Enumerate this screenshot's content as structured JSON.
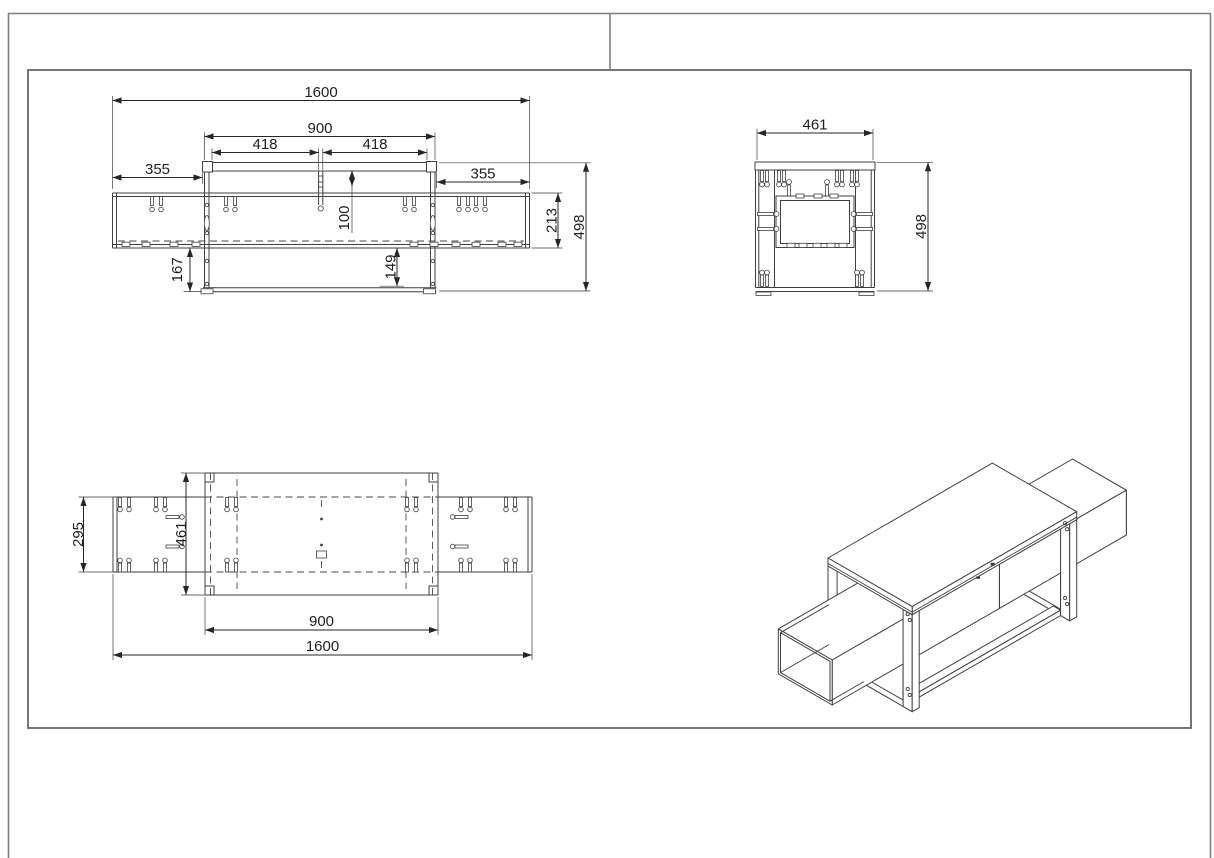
{
  "page": {
    "background": "#ffffff",
    "frame_color": "#7e7e7e",
    "line_color": "#3f3f3f",
    "dim_color": "#262626",
    "units": "mm"
  },
  "title_bar": {
    "left_cell_text": "",
    "right_cell_text": ""
  },
  "views": {
    "front": {
      "title": "front elevation",
      "dims": {
        "overall_width": "1600",
        "frame_width": "900",
        "opening_left": "418",
        "opening_right": "418",
        "overhang_left": "355",
        "overhang_right": "355",
        "top_inset": "100",
        "box_height": "213",
        "overall_height": "498",
        "floor_clearance": "167",
        "shelf_clearance": "149"
      }
    },
    "side": {
      "title": "side elevation",
      "dims": {
        "overall_depth": "461",
        "overall_height": "498"
      }
    },
    "plan": {
      "title": "plan view",
      "dims": {
        "box_depth": "295",
        "frame_depth": "461",
        "frame_width": "900",
        "overall_width": "1600"
      }
    },
    "isometric": {
      "title": "isometric view",
      "model_mm": {
        "frame_length": 900,
        "frame_depth": 461,
        "frame_height": 498,
        "slab_thickness": 38,
        "bar_width": 50,
        "shelf_height": 25,
        "box_span_left": -355,
        "box_join": 560,
        "box_span_right": 1255,
        "box_bottom": 168,
        "box_top": 381,
        "box_side_inset": 83,
        "wall": 12
      }
    }
  }
}
